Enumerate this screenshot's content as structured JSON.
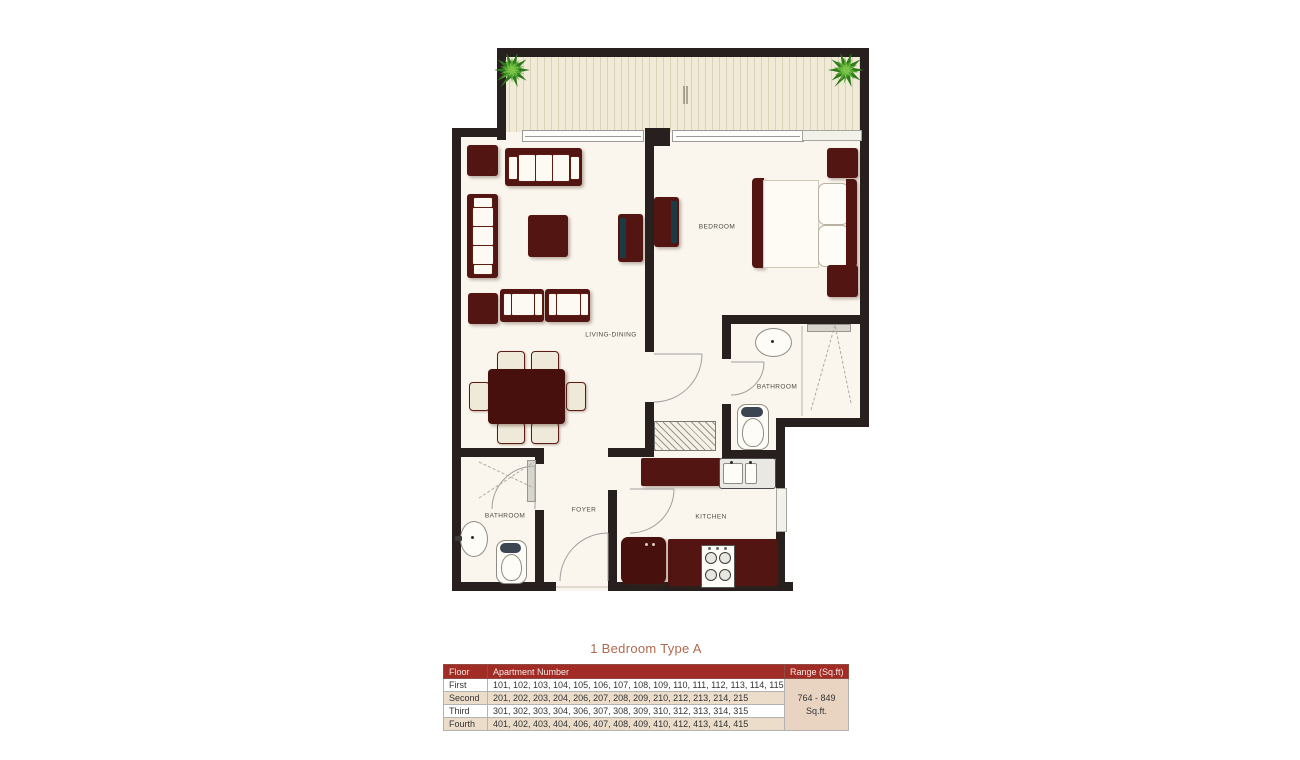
{
  "title": "1 Bedroom Type A",
  "plan": {
    "labels": {
      "living_dining": "LIVING-DINING",
      "bedroom": "BEDROOM",
      "bathroom_main": "BATHROOM",
      "bathroom_guest": "BATHROOM",
      "kitchen": "KITCHEN",
      "foyer": "FOYER"
    },
    "colors": {
      "wall": "#27201e",
      "floor": "#faf6ee",
      "balcony_floor": "#f0ead6",
      "furniture": "#521511",
      "tv_screen": "#1c3a44",
      "plant_green": "#4f9c2e"
    }
  },
  "table": {
    "headers": [
      "Floor",
      "Apartment Number",
      "Range (Sq.ft)"
    ],
    "rows": [
      {
        "floor": "First",
        "apartments": "101, 102, 103, 104, 105, 106, 107, 108, 109, 110, 111, 112, 113, 114, 115"
      },
      {
        "floor": "Second",
        "apartments": "201, 202, 203, 204, 206, 207, 208, 209, 210, 212, 213, 214, 215"
      },
      {
        "floor": "Third",
        "apartments": "301, 302, 303, 304, 306, 307, 308, 309, 310, 312, 313, 314, 315"
      },
      {
        "floor": "Fourth",
        "apartments": "401, 402, 403, 404, 406, 407, 408, 409, 410, 412, 413, 414, 415"
      }
    ],
    "range_value": "764 - 849",
    "range_unit": "Sq.ft.",
    "colors": {
      "header_bg": "#a12b25",
      "row_alt_bg": "#ecdcca",
      "range_bg": "#e9d4c1",
      "title_color": "#b06a4e"
    }
  }
}
